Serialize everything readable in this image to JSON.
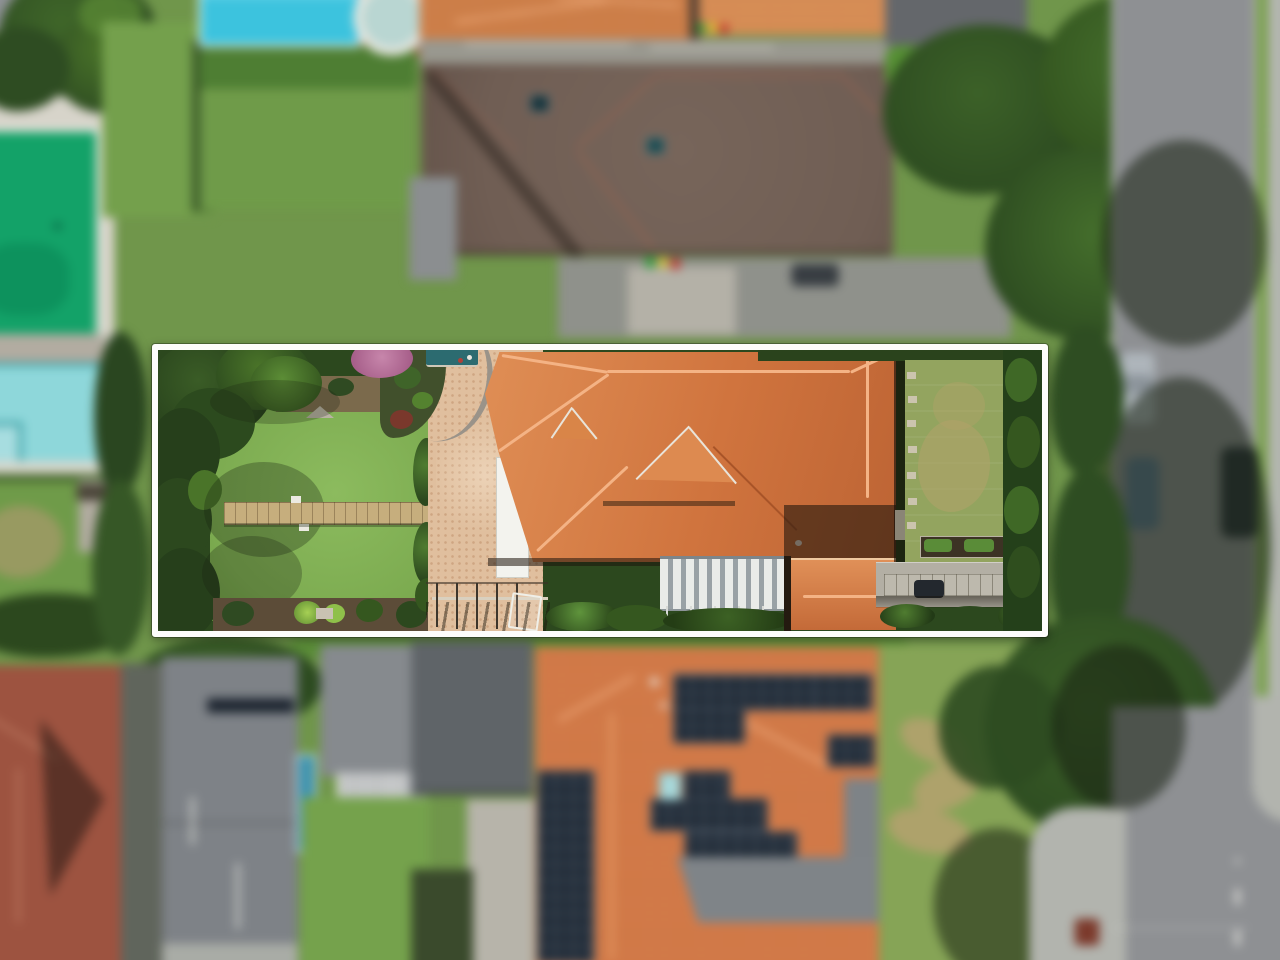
{
  "scene": {
    "type": "aerial-drone-photograph",
    "description": "Top-down aerial photograph of a suburban block. The background neighbourhood is blurred; a sharp strip bounded by a white rectangle highlights the featured property: a long terracotta-tile roofed house with brick-paved courtyard, timber boardwalk across the rear lawn, louvred pergola, detached garage, front lawn and driveway.",
    "labels": {
      "photo": "Aerial view of suburban properties",
      "frame": "White boundary outline highlighting the featured property",
      "featured_house": "Featured house with terracotta tiled roof",
      "back_lawn": "Rear lawn of featured property",
      "walkway": "Timber boardwalk crossing rear lawn",
      "paving": "Brick paved courtyard",
      "white_strip": "White carport panel beside roof",
      "louvre_pergola": "Louvred pergola roof",
      "garage": "Detached garage with terracotta roof",
      "front_lawn": "Front lawn with stepping stones",
      "driveway": "Front driveway with paver band",
      "dark_roof_house": "Neighbouring house with dark brown tiled roof",
      "solar_house": "Neighbouring house with rooftop solar panels",
      "pool_green": "Neighbouring green swimming pool",
      "pool_blue": "Neighbouring blue swimming pool",
      "pool_aqua": "Neighbouring aqua swimming pool",
      "road": "Street along right side with parked cars",
      "intersection": "Road intersection at bottom right",
      "trees": "Tree canopy",
      "parked_car": "Parked car"
    }
  },
  "colors": {
    "grass-base": "#70964b",
    "lawn-bright": "#7cab50",
    "lawn-front": "#93a45f",
    "hedge-dark": "#2c481e",
    "tree-dark": "#263f1b",
    "tree-mid": "#35571f",
    "tree-light": "#4a7429",
    "roof-terracotta": "#d0743e",
    "roof-terracotta-light": "#df8e55",
    "roof-terracotta-dark": "#bd6434",
    "ridge-light": "#f4b385",
    "roof-dark-house": "#705e54",
    "roof-red": "#9d5340",
    "roof-grey": "#7d8186",
    "roof-grey-dark": "#5e6367",
    "solar-panel": "#232d39",
    "road-grey": "#8e9093",
    "path-grey": "#b4b6b1",
    "paving-brick": "#e0bf9e",
    "walkway-tan": "#c6ae7d",
    "pool-green": "#13a268",
    "pool-blue": "#3cc3de",
    "pool-aqua": "#8ed7da",
    "white-frame": "#fdfdfb",
    "coping-white": "#d7d4ca"
  }
}
